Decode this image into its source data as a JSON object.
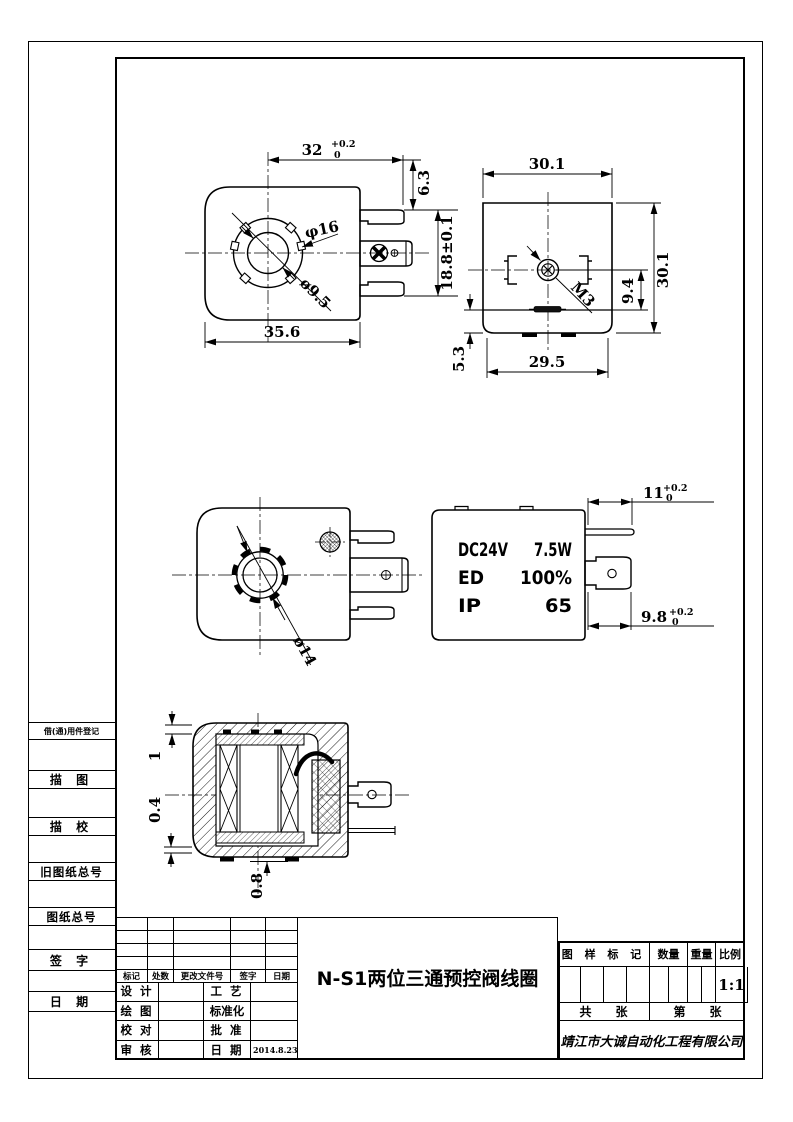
{
  "title_block": {
    "title": "N-S1两位三通预控阀线圈",
    "company": "靖江市大诚自动化工程有限公司",
    "revision_headers": [
      "标记",
      "处数",
      "更改文件号",
      "签字",
      "日期"
    ],
    "sign_rows": [
      {
        "left": "设 计",
        "mid": "工 艺",
        "value": ""
      },
      {
        "left": "绘 图",
        "mid": "标准化",
        "value": ""
      },
      {
        "left": "校 对",
        "mid": "批 准",
        "value": ""
      },
      {
        "left": "审 核",
        "mid": "日 期",
        "value": "2014.8.23"
      }
    ],
    "info": {
      "mark_header": "图 样 标 记",
      "qty_header": "数量",
      "weight_header": "重量",
      "scale_header": "比例",
      "scale_value": "1:1",
      "total_label": "共",
      "sheet_label": "张",
      "no_label": "第",
      "sheet_label2": "张"
    }
  },
  "margin_labels": [
    "借(通)用件登记",
    "描 图",
    "描 校",
    "旧图纸总号",
    "图纸总号",
    "签 字",
    "日 期"
  ],
  "views": {
    "front_top": {
      "width": "32",
      "width_tol_plus": "+0.2",
      "width_tol_zero": "0",
      "tab_offset": "6.3",
      "tab_span": "18.8±0.1",
      "body_width": "35.6",
      "boss_dia": "φ16",
      "bore_dia": "ø9.5"
    },
    "side_top": {
      "width": "30.1",
      "height": "30.1",
      "screw": "M3",
      "center_to_base": "9.4",
      "base_step": "5.3",
      "base_width": "29.5"
    },
    "front_mid": {
      "gear_dia": "ø14"
    },
    "side_mid": {
      "tab_len": "11",
      "tab_tol_plus": "+0.2",
      "tab_tol_zero": "0",
      "spade_len": "9.8",
      "spade_tol_plus": "+0.2",
      "spade_tol_zero": "0",
      "spec_rows": [
        [
          "DC24V",
          "7.5W"
        ],
        [
          "ED",
          "100%"
        ],
        [
          "IP",
          "65"
        ]
      ]
    },
    "section": {
      "wall": "1",
      "gap": "0.4",
      "foot": "0.8"
    }
  }
}
